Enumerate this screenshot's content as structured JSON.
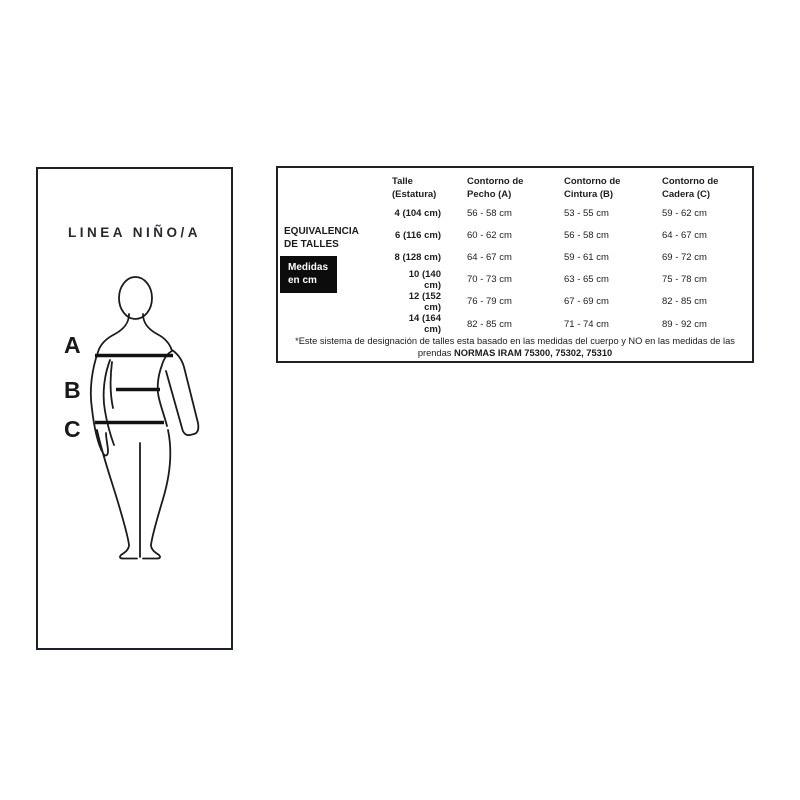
{
  "left_panel": {
    "title": "LINEA NIÑO/A",
    "measure_labels": {
      "a": "A",
      "b": "B",
      "c": "C"
    }
  },
  "size_chart": {
    "side_label": "EQUIVALENCIA\nDE TALLES",
    "badge": "Medidas\nen cm",
    "columns": [
      "Talle\n(Estatura)",
      "Contorno de\nPecho (A)",
      "Contorno de\nCintura (B)",
      "Contorno de\nCadera (C)"
    ],
    "rows": [
      {
        "talle": "4 (104 cm)",
        "pecho": "56 - 58 cm",
        "cintura": "53 - 55 cm",
        "cadera": "59 - 62 cm"
      },
      {
        "talle": "6 (116 cm)",
        "pecho": "60 - 62 cm",
        "cintura": "56 - 58 cm",
        "cadera": "64 - 67 cm"
      },
      {
        "talle": "8 (128 cm)",
        "pecho": "64 - 67 cm",
        "cintura": "59 - 61 cm",
        "cadera": "69 - 72 cm"
      },
      {
        "talle": "10 (140 cm)",
        "pecho": "70 - 73 cm",
        "cintura": "63 - 65 cm",
        "cadera": "75 - 78 cm"
      },
      {
        "talle": "12 (152 cm)",
        "pecho": "76 - 79 cm",
        "cintura": "67 - 69 cm",
        "cadera": "82 - 85 cm"
      },
      {
        "talle": "14 (164 cm)",
        "pecho": "82 - 85 cm",
        "cintura": "71 - 74 cm",
        "cadera": "89 - 92 cm"
      }
    ],
    "footnote_text": "*Este sistema de designación de talles esta basado en las medidas del cuerpo y NO en las medidas de las prendas",
    "footnote_bold": "NORMAS IRAM 75300, 75302, 75310"
  },
  "colors": {
    "border": "#1c212b",
    "badge_bg": "#0c0c0c",
    "text": "#1d1d1d"
  }
}
